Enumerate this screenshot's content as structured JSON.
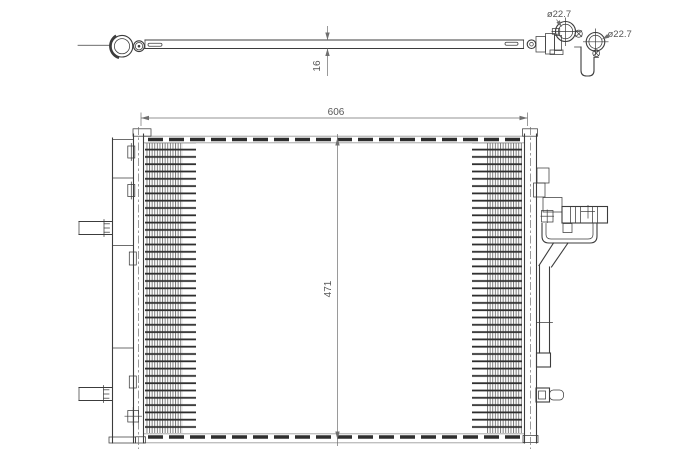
{
  "drawing": {
    "type": "technical-drawing",
    "subject": "condenser-air-conditioning",
    "views": {
      "top_view": "profile with inlet fitting and connection block",
      "front_view": "condenser core with side tanks, brackets and receiver drier"
    }
  },
  "dimensions": {
    "core_width": "606",
    "core_height": "471",
    "core_thickness": "16",
    "port_top_diameter": "ø22.7",
    "port_side_diameter": "ø22.7"
  },
  "colors": {
    "line": "#3c3c3c",
    "dim": "#6f6f6f",
    "dimtext": "#565656",
    "tube": "#2e2e2e",
    "fin": "#6e6e6e",
    "rail": "#9b9b9b",
    "background": "#ffffff"
  }
}
